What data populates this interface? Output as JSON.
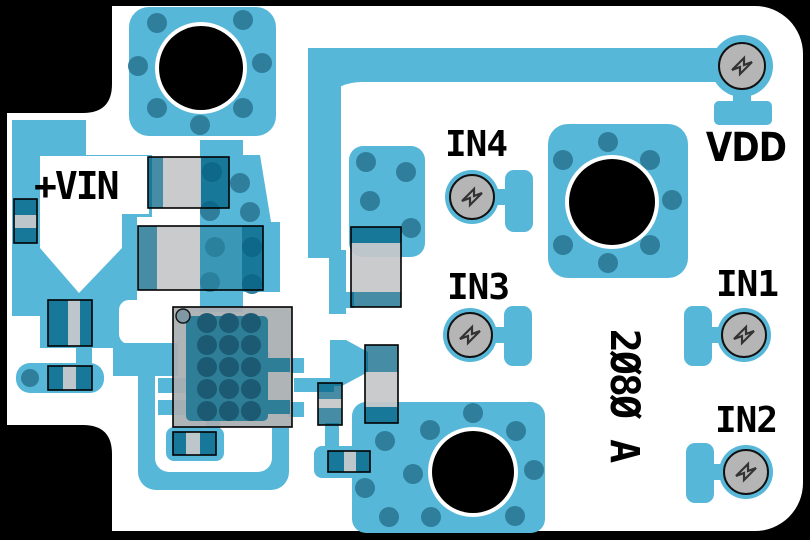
{
  "board": {
    "part_number": "2Ø8Ø A",
    "description": "PCB copper layout render with mounting holes, test points and silkscreen labels"
  },
  "labels": {
    "vin": "+VIN",
    "vdd": "VDD",
    "in1": "IN1",
    "in2": "IN2",
    "in3": "IN3",
    "in4": "IN4"
  },
  "colors": {
    "background": "#000000",
    "board": "#ffffff",
    "copper": "#57b7d8",
    "via": "#2f7f9c",
    "hole": "#000000",
    "comp_gray": "rgba(197,199,200,0.93)",
    "comp_teal": "rgba(0,95,130,0.72)",
    "comp_teal_light": "rgba(40,130,160,0.60)",
    "ic_gray": "rgba(169,174,178,0.93)",
    "ic_pad_teal": "#2e7e98",
    "ic_dot": "#1c5a73",
    "tp_gray": "#b5b5b5",
    "glyph": "#333333",
    "label": "#000000"
  }
}
